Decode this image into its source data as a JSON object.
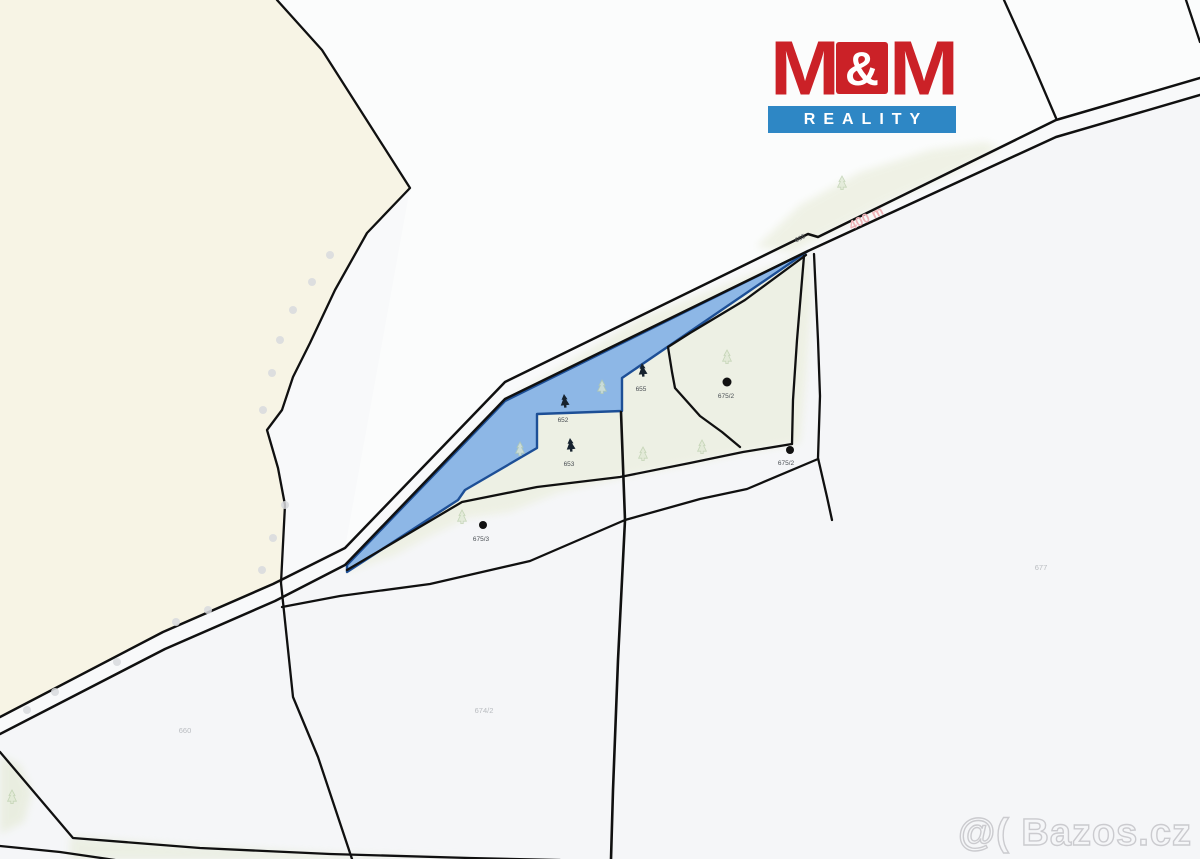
{
  "logo": {
    "m_left": "M",
    "amp": "&",
    "m_right": "M",
    "reality": "REALITY",
    "red": "#cb2127",
    "blue": "#2e87c5"
  },
  "watermark": {
    "text": "@( Bazos.cz"
  },
  "map": {
    "colors": {
      "highlight_fill": "#8db7e6",
      "highlight_border": "#1d4f96",
      "forest_beige": "#f7f4e5",
      "meadow_green": "#edf0e2",
      "boundary_line": "#101010",
      "marker_dot": "#d9dbde",
      "faint_tree": "#b9cdaa"
    },
    "road_label": {
      "text": "665"
    },
    "distance_label": {
      "text": "400 m",
      "color": "#f0b3b8"
    },
    "tree_labels": [
      {
        "text": "652"
      },
      {
        "text": "653"
      },
      {
        "text": "655"
      },
      {
        "text": "675/2"
      },
      {
        "text": "675/3"
      },
      {
        "text": "675/2"
      }
    ],
    "parcel_labels": [
      {
        "text": "660"
      },
      {
        "text": "674/2"
      },
      {
        "text": "677"
      }
    ]
  }
}
